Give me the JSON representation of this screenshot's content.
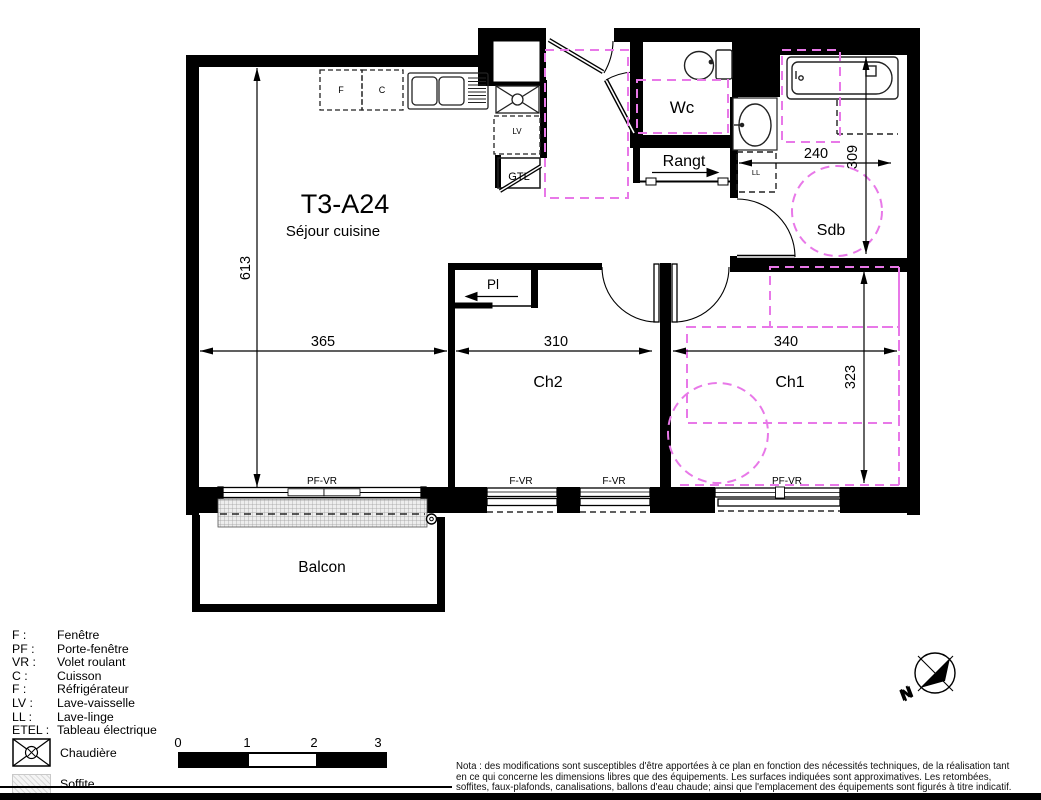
{
  "plan": {
    "title": "T3-A24",
    "subtitle": "Séjour cuisine",
    "rooms": {
      "wc": "Wc",
      "rangt": "Rangt",
      "sdb": "Sdb",
      "ch1": "Ch1",
      "ch2": "Ch2",
      "pl": "Pl",
      "balcon": "Balcon"
    },
    "equipment": {
      "f": "F",
      "c": "C",
      "lv": "LV",
      "gtl": "GTL",
      "ll": "LL"
    },
    "windows": {
      "sejour": "PF-VR",
      "ch2_a": "F-VR",
      "ch2_b": "F-VR",
      "ch1": "PF-VR"
    },
    "dimensions": {
      "sejour_height": "613",
      "sejour_width": "365",
      "ch2_width": "310",
      "ch1_width": "340",
      "sdb_width": "240",
      "sdb_height": "309",
      "ch1_height": "323"
    }
  },
  "legend": {
    "items": [
      {
        "abbr": "F :",
        "label": "Fenêtre"
      },
      {
        "abbr": "PF :",
        "label": "Porte-fenêtre"
      },
      {
        "abbr": "VR :",
        "label": "Volet roulant"
      },
      {
        "abbr": "C :",
        "label": "Cuisson"
      },
      {
        "abbr": "F :",
        "label": "Réfrigérateur"
      },
      {
        "abbr": "LV :",
        "label": "Lave-vaisselle"
      },
      {
        "abbr": "LL :",
        "label": "Lave-linge"
      },
      {
        "abbr": "ETEL :",
        "label": "Tableau électrique"
      }
    ],
    "chaudiere": "Chaudière",
    "soffite": "Soffite"
  },
  "scalebar": {
    "t0": "0",
    "t1": "1",
    "t2": "2",
    "t3": "3"
  },
  "compass": {
    "north": "N"
  },
  "nota": {
    "line1": "Nota : des modifications sont susceptibles d'être apportées à ce plan en fonction des nécessités techniques, de la réalisation tant",
    "line2": "en ce qui concerne les dimensions libres que des équipements. Les surfaces indiquées sont approximatives. Les retombées,",
    "line3": "soffites, faux-plafonds, canalisations, ballons d'eau chaude; ainsi que l'emplacement des équipements sont figurés à titre indicatif."
  },
  "colors": {
    "wall": "#000000",
    "accent": "#e878e8"
  }
}
